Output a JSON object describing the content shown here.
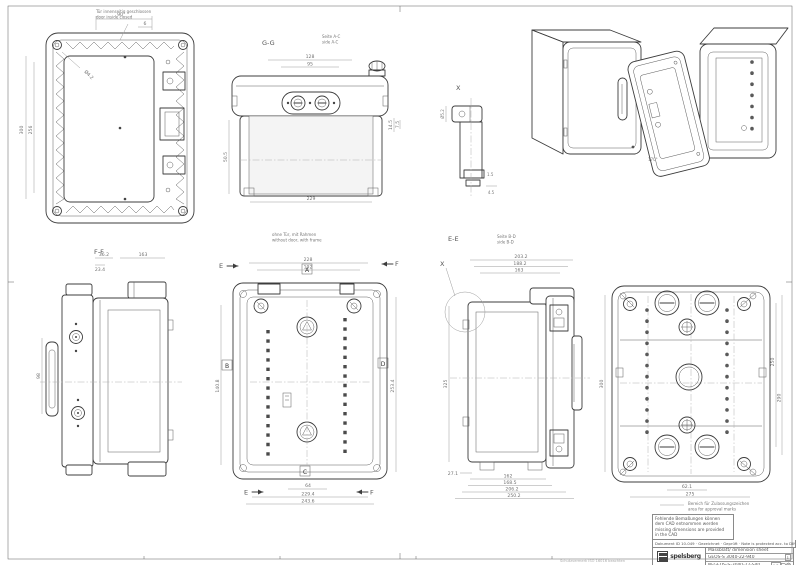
{
  "labels": {
    "g_g": "G-G",
    "seite_ac_de": "Seite A-C",
    "seite_ac_en": "side  A-C",
    "e_e": "E-E",
    "seite_bd_de": "Seite B-D",
    "seite_bd_en": "side  B-D",
    "f_f": "F-F",
    "x_marker": "X",
    "x_detail": "X",
    "angle": "170°",
    "box_a": "A",
    "box_b": "B",
    "box_c": "C",
    "box_d": "D",
    "arrow_e_top": "E",
    "arrow_f_top": "F",
    "arrow_e_bottom": "E",
    "arrow_f_bottom": "F"
  },
  "notes": {
    "door_de": "Tür innenseitig geschlossen",
    "door_en": "door inside closed",
    "frame_de": "ohne Tür, mit Rahmen",
    "frame_en": "without door, with frame",
    "approval_de": "Bereich für Zulassungszeichen",
    "approval_en": "area for approval marks",
    "cad_l1": "Fehlende Bemaßungen können",
    "cad_l2": "dem CAD entnommen werden",
    "cad_l3": "missing dimensions are provided",
    "cad_l4": "in the CAD",
    "doc_row": "Dokument ID 10-049 · Gezeichnet · Geprüft · Note is protected acc. to DIN ISO 16016 · Maßstab 1:2",
    "protect": "Schutzvermerk ISO 16016 beachten"
  },
  "title_block": {
    "brand": "spelsberg",
    "title": "Massblatt/ dimension sheet",
    "product": "GEOS-S 3040-22-940",
    "doc_no": "M-GEOS-S-3040-22-S40",
    "page": "1/1",
    "rev": "1"
  },
  "views": {
    "back": {
      "dims": [
        "90",
        "6",
        "300",
        "256",
        "Ø4.2"
      ]
    },
    "top": {
      "dims": [
        "128",
        "95",
        "14.5",
        "7.5",
        "229",
        "50.5"
      ]
    },
    "front": {
      "dims": [
        "228",
        "192",
        "140.8",
        "253.4",
        "64",
        "229.4",
        "243.6"
      ]
    },
    "ee": {
      "dims": [
        "203.2",
        "188.2",
        "163",
        "325",
        "27.1",
        "162",
        "168.5",
        "206.2",
        "250.2"
      ]
    },
    "ff": {
      "dims": [
        "36.2",
        "23.4",
        "163",
        "98"
      ]
    },
    "rear": {
      "dims": [
        "300",
        "250",
        "290",
        "62.1",
        "275"
      ]
    },
    "detail": {
      "dims": [
        "Ø5.2",
        "4.5",
        "1.5"
      ]
    }
  }
}
